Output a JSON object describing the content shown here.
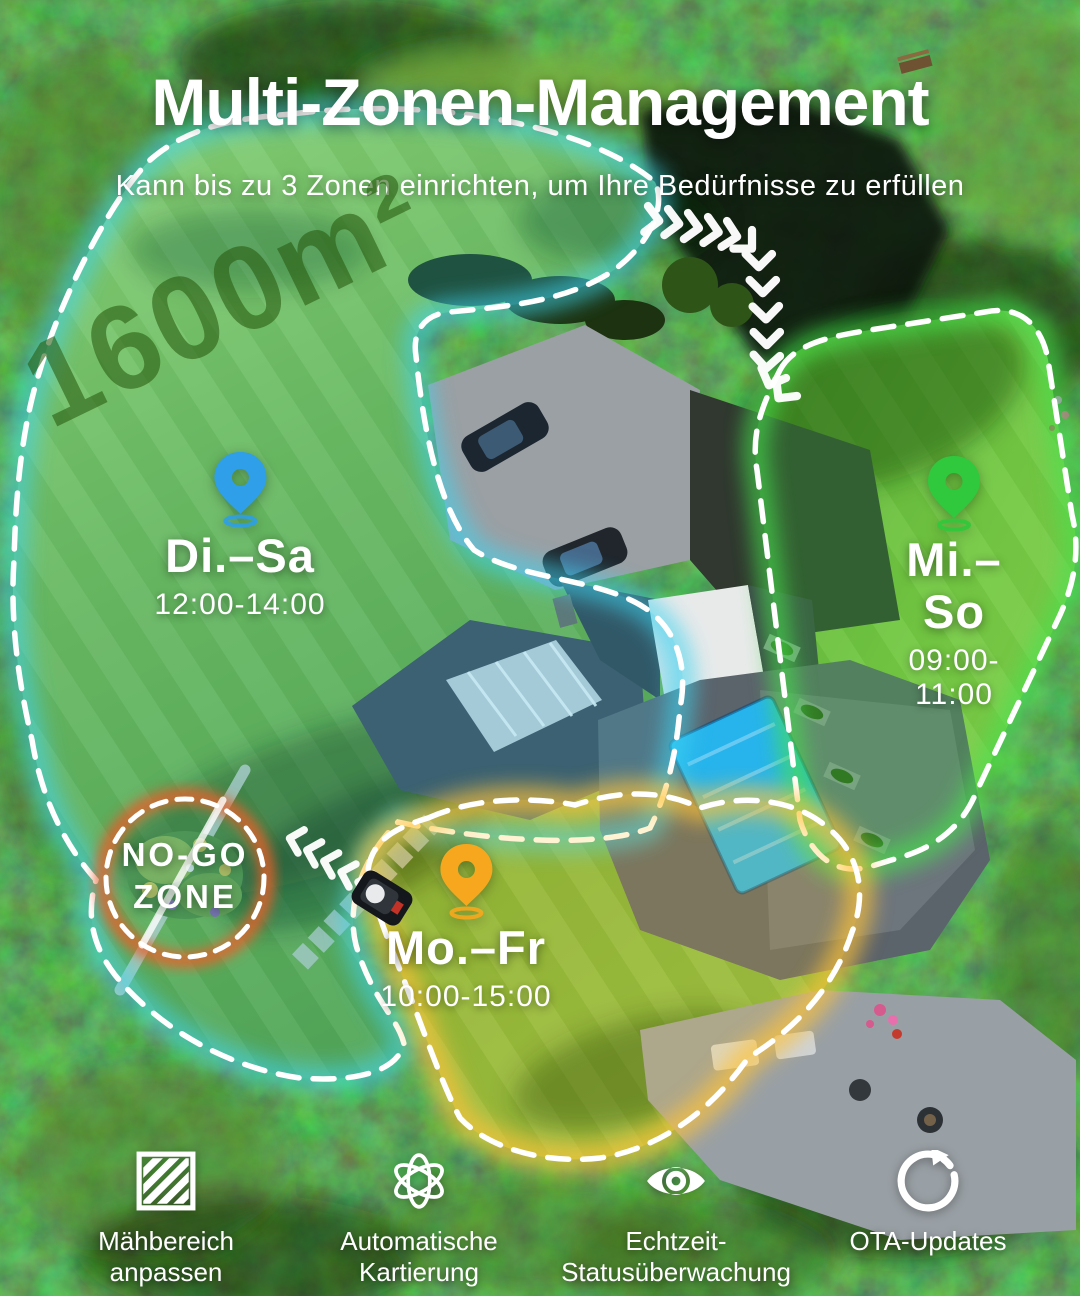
{
  "header": {
    "title": "Multi-Zonen-Management",
    "subtitle": "Kann bis zu 3 Zonen einrichten, um Ihre Bedürfnisse zu erfüllen"
  },
  "lawn": {
    "area_label": "1600m²"
  },
  "zones": [
    {
      "name": "zone-1",
      "days": "Di.–Sa",
      "time": "12:00-14:00",
      "pin_color": "#2e9fe8"
    },
    {
      "name": "zone-2",
      "days": "Mi.–So",
      "time": "09:00-11:00",
      "pin_color": "#30c83c"
    },
    {
      "name": "zone-3",
      "days": "Mo.–Fr",
      "time": "10:00-15:00",
      "pin_color": "#f7a71d"
    }
  ],
  "no_go_zone": {
    "line1": "NO-GO",
    "line2": "ZONE",
    "ring_color": "#e8602c"
  },
  "features": [
    {
      "line1": "Mähbereich",
      "line2": "anpassen",
      "icon": "hatched-area-icon"
    },
    {
      "line1": "Automatische",
      "line2": "Kartierung",
      "icon": "auto-mapping-icon"
    },
    {
      "line1": "Echtzeit-",
      "line2": "Statusüberwachung",
      "icon": "realtime-monitoring-eye-icon"
    },
    {
      "line1": "OTA-Updates",
      "line2": "",
      "icon": "ota-update-icon"
    }
  ],
  "colors": {
    "zone_border": "#ffffff",
    "zone1_glow": "#3fd4f0",
    "zone2_glow": "#46e14e",
    "zone3_glow": "#ffc337",
    "text": "#ffffff"
  }
}
